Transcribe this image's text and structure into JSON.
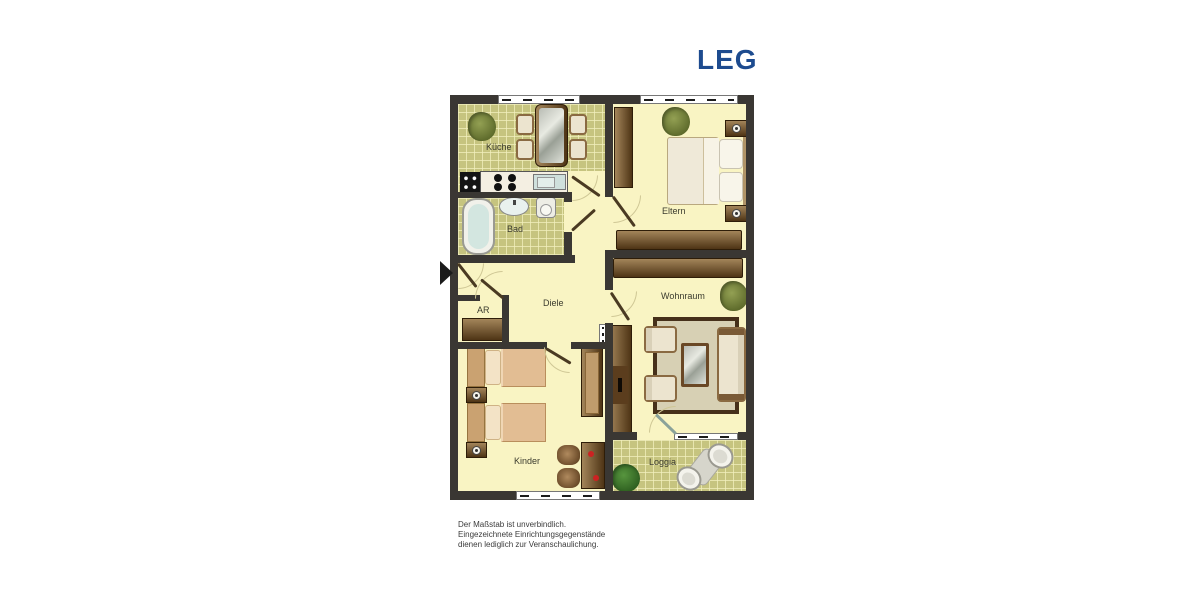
{
  "brand": {
    "logo_text": "LEG",
    "logo_color": "#1d4b8f"
  },
  "floor_plan": {
    "rooms": [
      {
        "id": "kueche",
        "label": "Küche",
        "floor": "green-tile"
      },
      {
        "id": "bad",
        "label": "Bad",
        "floor": "green-tile"
      },
      {
        "id": "eltern",
        "label": "Eltern",
        "floor": "yellow"
      },
      {
        "id": "diele",
        "label": "Diele",
        "floor": "yellow"
      },
      {
        "id": "ar",
        "label": "AR",
        "floor": "yellow"
      },
      {
        "id": "wohnraum",
        "label": "Wohnraum",
        "floor": "yellow"
      },
      {
        "id": "kinder",
        "label": "Kinder",
        "floor": "yellow"
      },
      {
        "id": "loggia",
        "label": "Loggia",
        "floor": "green-tile"
      }
    ],
    "furniture": {
      "kueche": [
        "plant",
        "dining-table",
        "4 chairs",
        "stove-cabinet",
        "counter with hob and sink"
      ],
      "bad": [
        "bathtub",
        "washbasin",
        "toilet"
      ],
      "eltern": [
        "wardrobe",
        "plant",
        "double-bed",
        "2 nightstands with lamps",
        "sideboard"
      ],
      "wohnraum": [
        "sideboard",
        "plant",
        "tall cabinet",
        "radiator",
        "rug",
        "2 armchairs",
        "sofa",
        "coffee-table"
      ],
      "kinder": [
        "2 single beds",
        "2 nightstands with lamps",
        "wardrobe",
        "desk",
        "2 chairs"
      ],
      "loggia": [
        "plant",
        "2 lounge chairs",
        "small table"
      ],
      "diele": [
        "entrance arrow",
        "AR cabinet"
      ]
    },
    "disclaimer": [
      "Der Maßstab ist unverbindlich.",
      "Eingezeichnete Einrichtungsgegenstände",
      "dienen lediglich zur Veranschaulichung."
    ]
  },
  "colors": {
    "wall": "#3a3733",
    "floor_yellow": "#f9f4c3",
    "floor_tile_green": "#c6c47f",
    "furniture_brown": "#6a4a28",
    "logo_blue": "#1d4b8f"
  }
}
